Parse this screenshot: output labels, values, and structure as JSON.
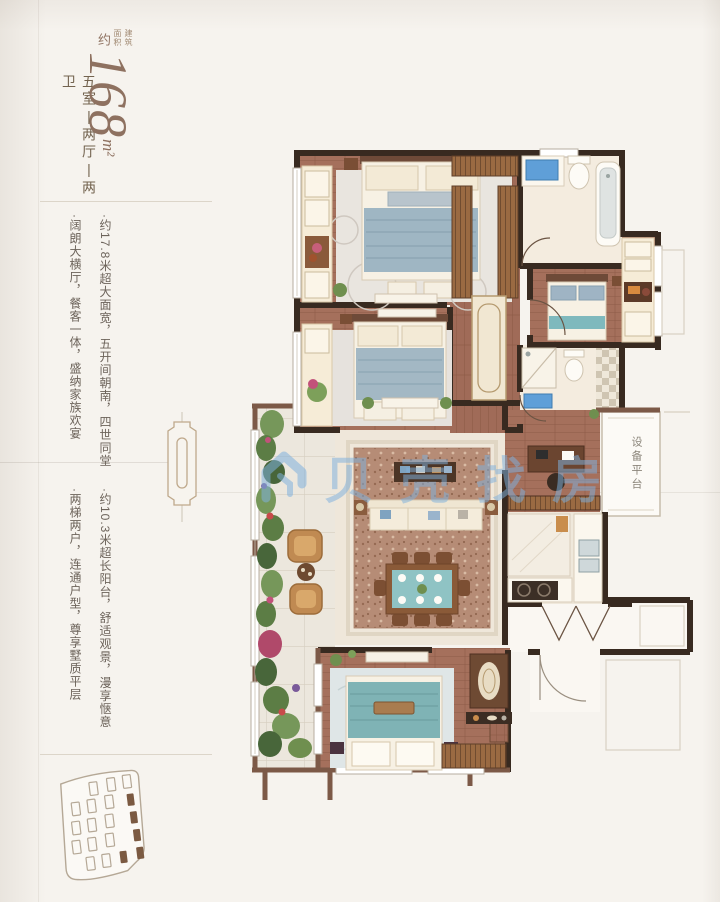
{
  "header": {
    "area_note": "建筑面积",
    "approx": "约",
    "area_value": "168",
    "area_unit": "m²",
    "layout": "五室|两厅|两卫"
  },
  "features": {
    "group1": [
      "·约17.8米超大面宽，五开间朝南，四世同堂",
      "·阔朗大横厅，餐客一体，盛纳家族欢宴"
    ],
    "group2": [
      "·约10.3米超长阳台，舒适观景，漫享惬意",
      "·两梯两户，连通户型，尊享墅质平层"
    ]
  },
  "floorplan": {
    "equipment_platform_label": "设备平台",
    "watermark_text": "贝壳找房"
  },
  "colors": {
    "accent_brown": "#8e7160",
    "wall_dark": "#382a20",
    "wall_exterior": "#7c5947",
    "wood_floor": "#a5705c",
    "tile_floor": "#f4ecdf",
    "balcony_floor": "#ece7dd",
    "watermark_blue": "#7fb0dd",
    "bed_blue": "#9fb6c3",
    "dining_teal": "#8fc3c4"
  }
}
